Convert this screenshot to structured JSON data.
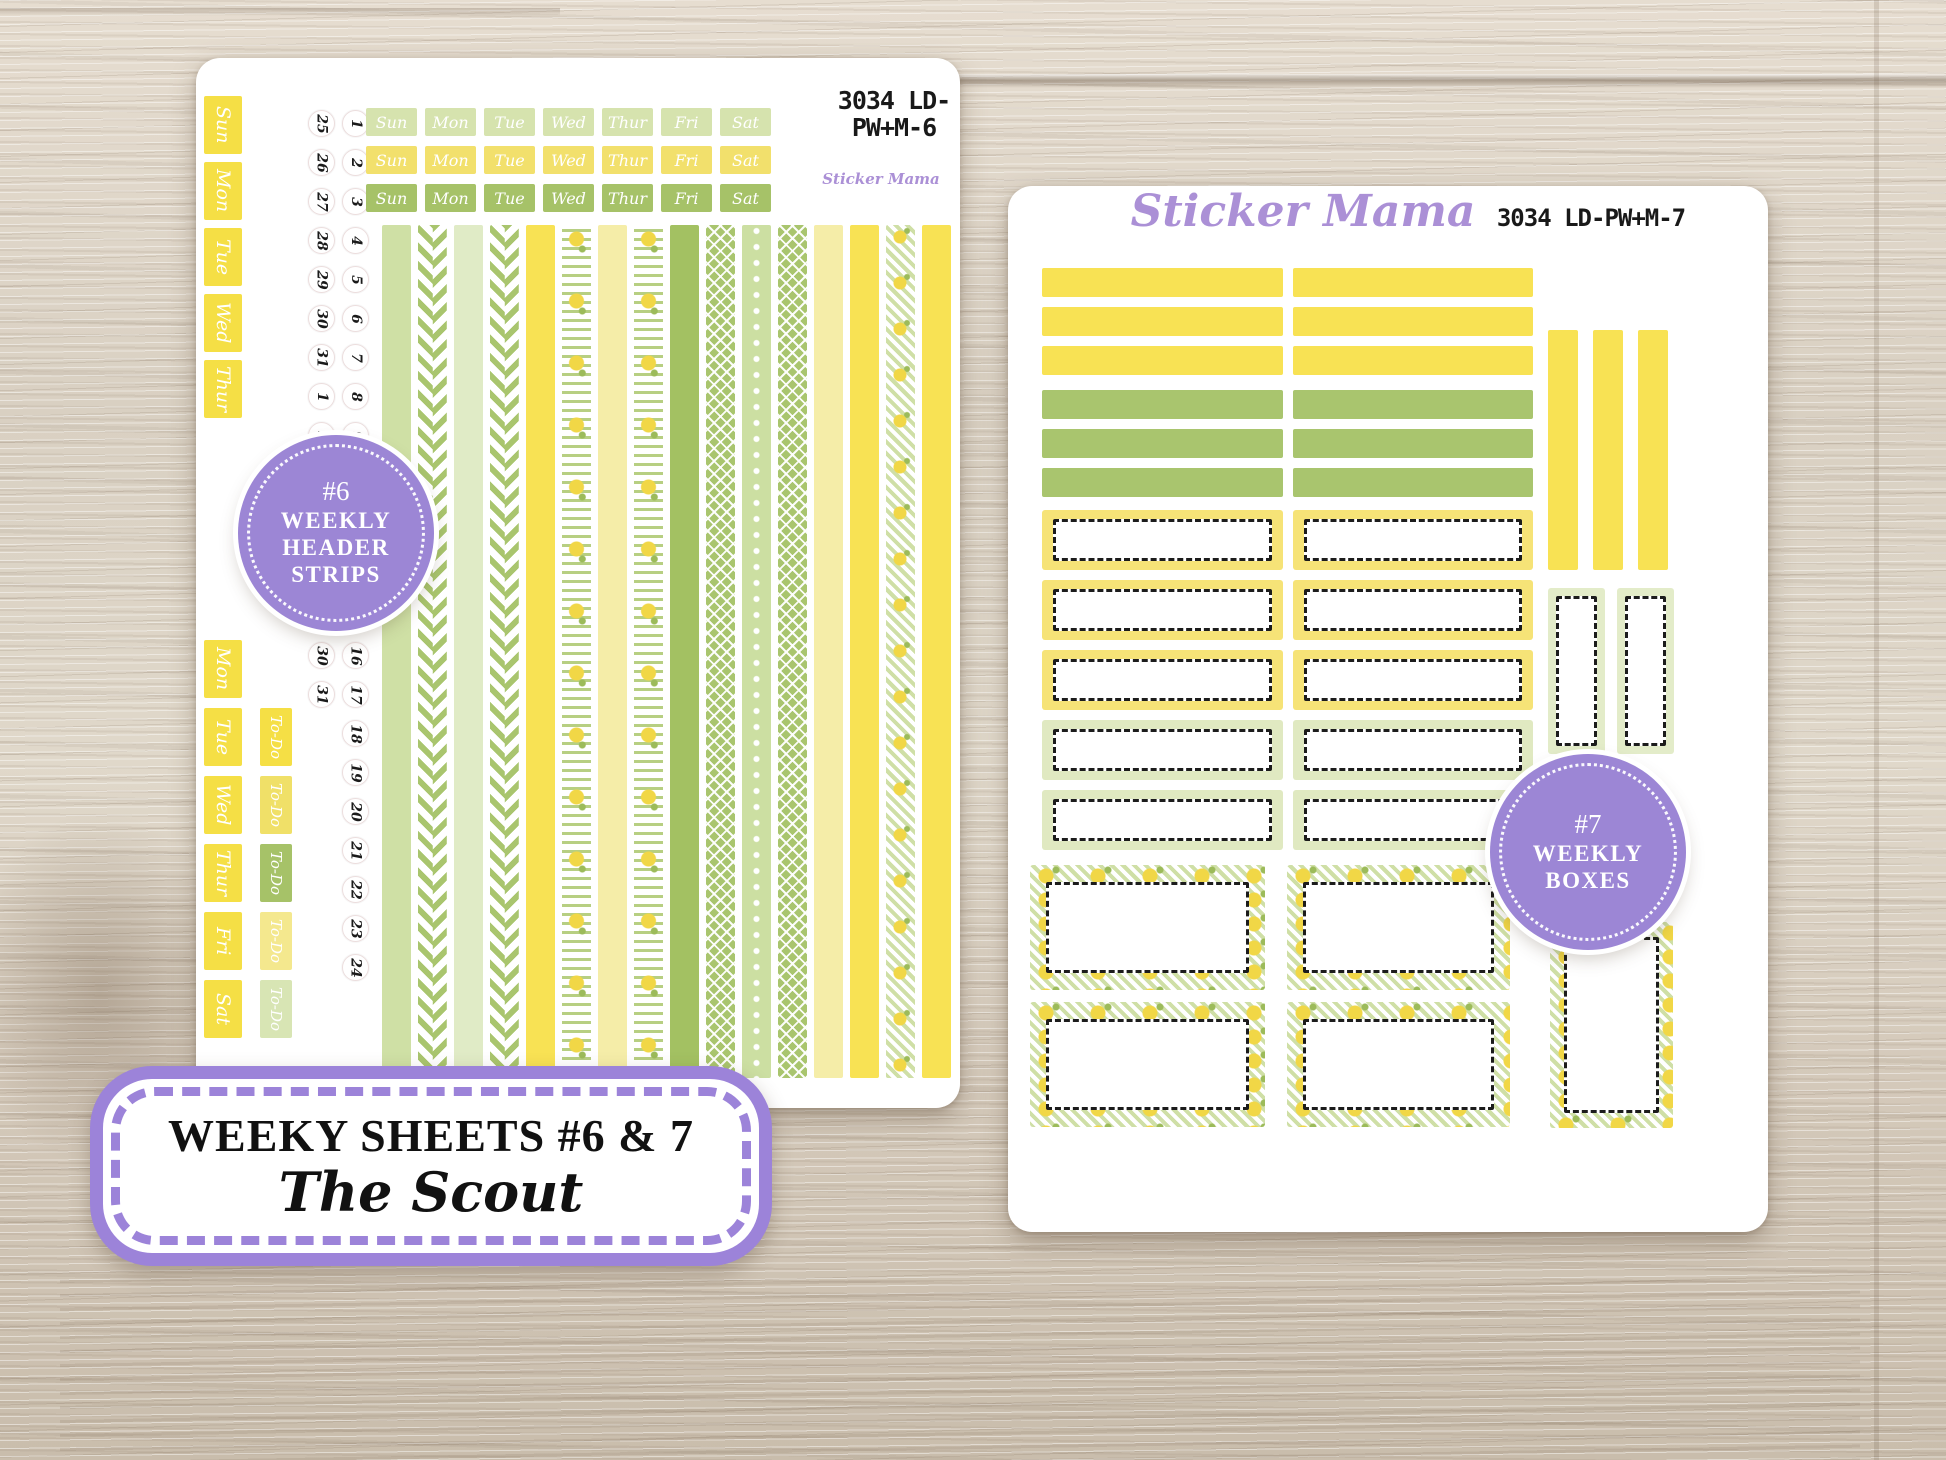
{
  "title_box": {
    "line1": "WEEKY SHEETS #6 & 7",
    "line2": "The Scout",
    "border_color": "#9c83d9"
  },
  "brand_color": "#ab90d6",
  "badge_color": "#9c86d5",
  "sheet1": {
    "code_line1": "3034 LD-",
    "code_line2": "PW+M-6",
    "brand": "Sticker Mama",
    "badge": {
      "number": "#6",
      "line1": "WEEKLY",
      "line2": "HEADER",
      "line3": "STRIPS"
    },
    "tabs_top": [
      "Sun",
      "Mon",
      "Tue",
      "Wed",
      "Thur"
    ],
    "tabs_bottom": [
      "Mon",
      "Tue",
      "Wed",
      "Thur",
      "Fri",
      "Sat"
    ],
    "todo_tabs": [
      {
        "t": "To-Do",
        "c": "td-yellow"
      },
      {
        "t": "To-Do",
        "c": "td-yellow2"
      },
      {
        "t": "To-Do",
        "c": "td-green"
      },
      {
        "t": "To-Do",
        "c": "td-paleyellow"
      },
      {
        "t": "To-Do",
        "c": "td-palegreen"
      }
    ],
    "dates_col_a_top": [
      "25",
      "26",
      "27",
      "28",
      "29",
      "30",
      "31",
      "1",
      "2"
    ],
    "dates_col_b_top": [
      "1",
      "2",
      "3",
      "4",
      "5",
      "6",
      "7",
      "8",
      "9"
    ],
    "dates_col_a_bottom": [
      "30",
      "31"
    ],
    "dates_col_b_bottom": [
      "16",
      "17",
      "18",
      "19",
      "20",
      "21",
      "22",
      "23",
      "24"
    ],
    "header_cells": [
      {
        "t": "Sun",
        "c": "hc-light"
      },
      {
        "t": "Mon",
        "c": "hc-light"
      },
      {
        "t": "Tue",
        "c": "hc-light"
      },
      {
        "t": "Wed",
        "c": "hc-light"
      },
      {
        "t": "Thur",
        "c": "hc-light"
      },
      {
        "t": "Fri",
        "c": "hc-light"
      },
      {
        "t": "Sat",
        "c": "hc-light"
      },
      {
        "t": "Sun",
        "c": "hc-yellow"
      },
      {
        "t": "Mon",
        "c": "hc-yellow"
      },
      {
        "t": "Tue",
        "c": "hc-yellow"
      },
      {
        "t": "Wed",
        "c": "hc-yellow"
      },
      {
        "t": "Thur",
        "c": "hc-yellow"
      },
      {
        "t": "Fri",
        "c": "hc-yellow"
      },
      {
        "t": "Sat",
        "c": "hc-yellow"
      },
      {
        "t": "Sun",
        "c": "hc-green"
      },
      {
        "t": "Mon",
        "c": "hc-green"
      },
      {
        "t": "Tue",
        "c": "hc-green"
      },
      {
        "t": "Wed",
        "c": "hc-green"
      },
      {
        "t": "Thur",
        "c": "hc-green"
      },
      {
        "t": "Fri",
        "c": "hc-green"
      },
      {
        "t": "Sat",
        "c": "hc-green"
      }
    ],
    "washi_strips": [
      "w-sage",
      "w-chevron",
      "w-palesage",
      "w-chevron",
      "w-yellow",
      "w-lemonstripe",
      "w-paleyellow",
      "w-lemonstripe",
      "w-green",
      "w-lattice",
      "w-sagedot",
      "w-lattice",
      "w-paleyellow",
      "w-yellow",
      "w-lemonchevron",
      "w-yellow"
    ]
  },
  "sheet2": {
    "brand": "Sticker Mama",
    "code": "3034 LD-PW+M-7",
    "badge": {
      "number": "#7",
      "line1": "WEEKLY",
      "line2": "BOXES"
    },
    "strips_col1": [
      "st-yellow",
      "st-yellow",
      "st-yellow",
      "st-green",
      "st-green",
      "st-green"
    ],
    "strips_col2": [
      "st-yellow",
      "st-yellow",
      "st-yellow",
      "st-green",
      "st-green",
      "st-green"
    ],
    "vertical_bars": [
      "st-yellow",
      "st-yellow",
      "st-yellow"
    ],
    "label_boxes_col1": [
      "lb-yellow",
      "lb-yellow",
      "lb-yellow",
      "lb-green",
      "lb-green"
    ],
    "label_boxes_col2": [
      "lb-yellow",
      "lb-yellow",
      "lb-yellow",
      "lb-green",
      "lb-green"
    ],
    "side_boxes": [
      "sidebox",
      "sidebox"
    ],
    "lemon_boxes_col1": [
      "lemonbox",
      "lemonbox"
    ],
    "lemon_boxes_col2": [
      "lemonbox",
      "lemonbox"
    ]
  }
}
